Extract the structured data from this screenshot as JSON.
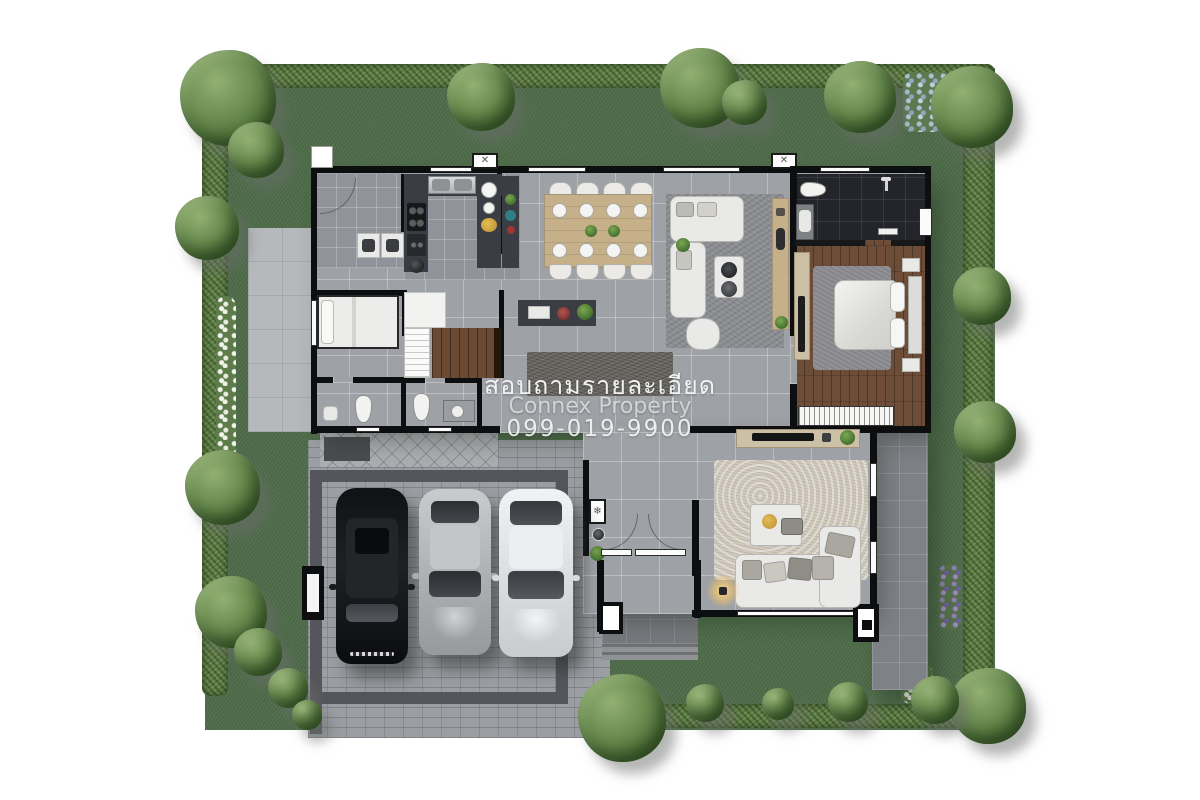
{
  "watermark": {
    "inquiry": "สอบถามรายละเอียด",
    "brand": "Connex Property",
    "phone": "099-019-9900"
  },
  "icons": {
    "ac_unit_glyph": "✕",
    "air_conditioner_glyph": "❄"
  },
  "colors": {
    "background": "#ffffff",
    "grass": "#4e6c49",
    "hedge": "#5e7d46",
    "floor_tile": "#9ea1a6",
    "floor_tile_dark": "#90939a",
    "wall": "#0d0e10",
    "wood_floor": "#6d4c38",
    "dark_bath_tile": "#23252a",
    "counter": "#3a3d43",
    "cabinet_wood": "#c6b089",
    "driveway": "#9b9ea2",
    "parking_band": "#54565b",
    "porch": "#77797e",
    "terrace": "#7e8186",
    "concrete": "#b6b9bc",
    "rug_dark": "#64625c",
    "rug_fluffy": "#cfc8bb",
    "sofa_white": "#e9e9e7",
    "bed_white": "#ececea",
    "car_black": "#17181b",
    "car_silver": "#b9bbbe",
    "car_white": "#e9eaec",
    "plant_green": "#4c7a33",
    "accent_yellow": "#c79b3a",
    "watermark_text": "#f2f2f2"
  }
}
